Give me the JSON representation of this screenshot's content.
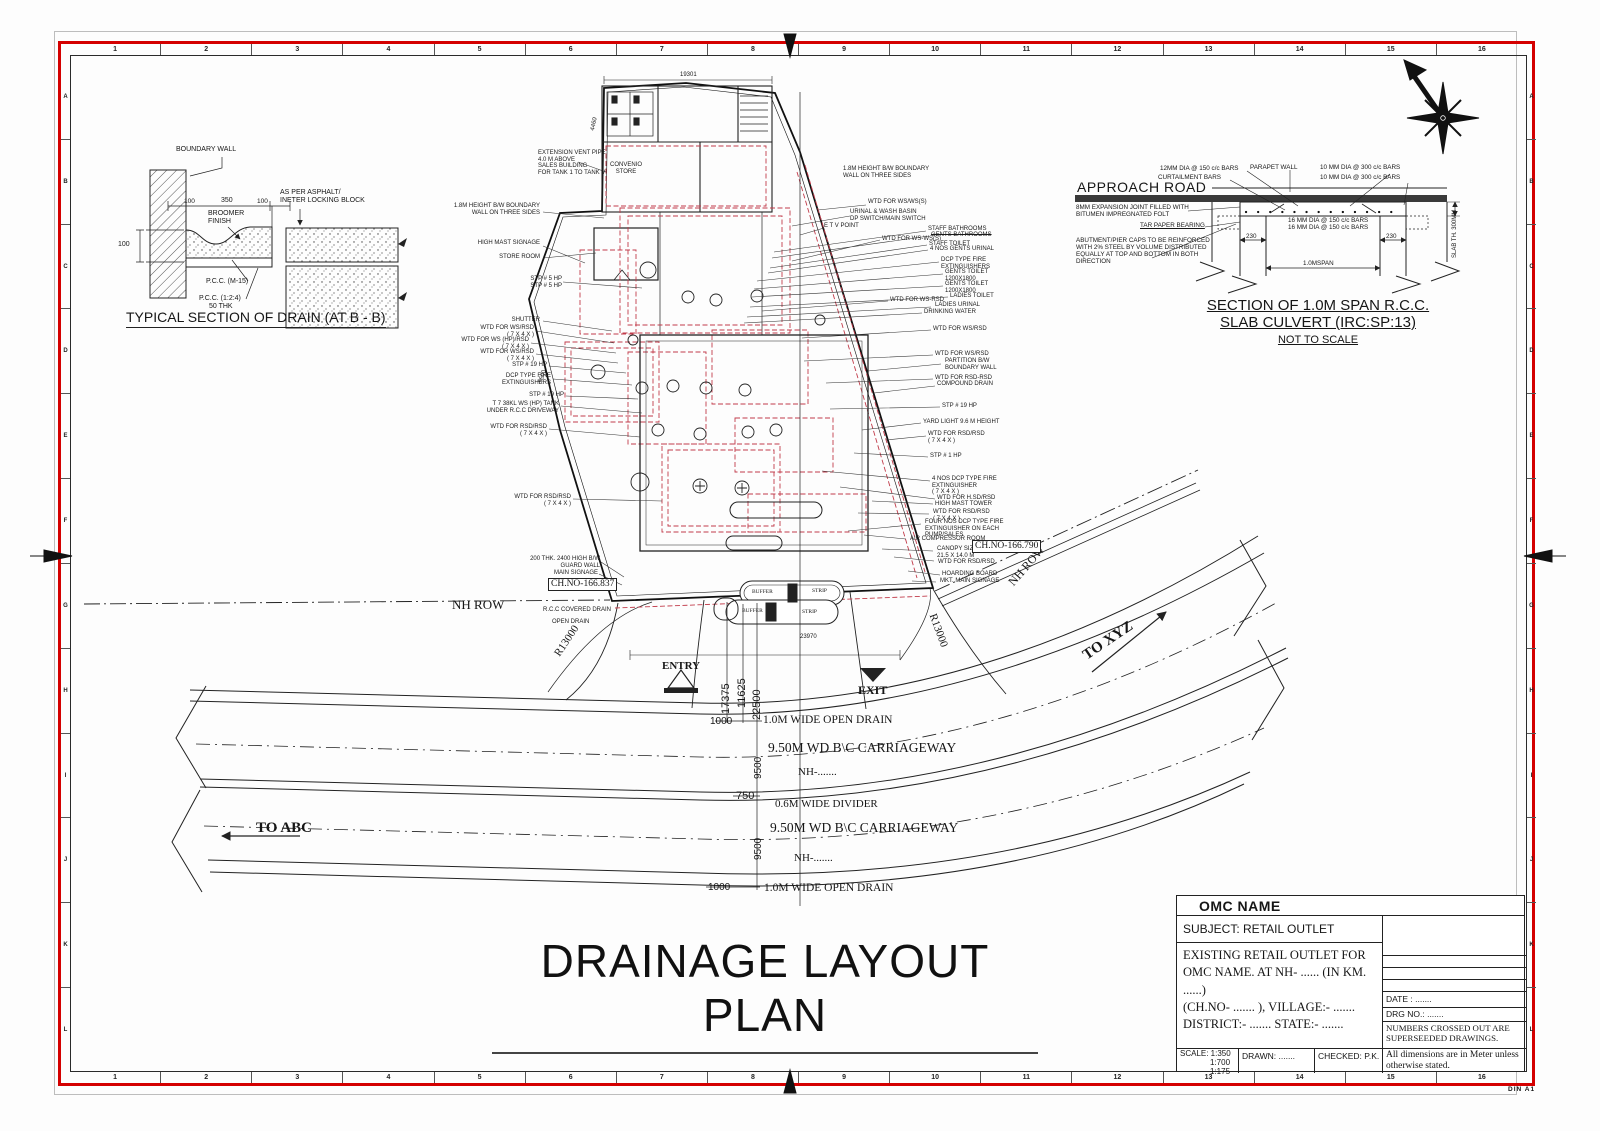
{
  "sheet": {
    "size_label": "DIN  A1"
  },
  "grid": {
    "cols": [
      "1",
      "2",
      "3",
      "4",
      "5",
      "6",
      "7",
      "8",
      "9",
      "10",
      "11",
      "12",
      "13",
      "14",
      "15",
      "16"
    ],
    "rows": [
      "A",
      "B",
      "C",
      "D",
      "E",
      "F",
      "G",
      "H",
      "I",
      "J",
      "K",
      "L"
    ]
  },
  "plan": {
    "title": "DRAINAGE LAYOUT PLAN",
    "small_left": [
      {
        "text": "EXTENSION VENT PIPE\n4.0 M ABOVE\nSALES BUILDING\nFOR TANK 1 TO TANK V",
        "x": 538,
        "y": 150
      },
      {
        "text": "1.8M HEIGHT B/W BOUNDARY\nWALL ON THREE SIDES",
        "x": 540,
        "y": 203,
        "cls": "ra"
      },
      {
        "text": "HIGH MAST SIGNAGE",
        "x": 540,
        "y": 240,
        "cls": "ra"
      },
      {
        "text": "STORE ROOM",
        "x": 540,
        "y": 254,
        "cls": "ra"
      },
      {
        "text": "STP # 5 HP",
        "x": 562,
        "y": 276,
        "cls": "ra"
      },
      {
        "text": "STP # 5 HP",
        "x": 562,
        "y": 283,
        "cls": "ra"
      },
      {
        "text": "SHUTTER",
        "x": 540,
        "y": 317,
        "cls": "ra"
      },
      {
        "text": "WTD FOR WS/RSD\n( 7 X 4 X )",
        "x": 534,
        "y": 325,
        "cls": "ra"
      },
      {
        "text": "WTD FOR WS (HP)/RSD\n( 7 X 4 X )",
        "x": 529,
        "y": 337,
        "cls": "ra"
      },
      {
        "text": "WTD FOR WS/RSD\n( 7 X 4 X )",
        "x": 534,
        "y": 349,
        "cls": "ra"
      },
      {
        "text": "STP # 19 HP",
        "x": 547,
        "y": 362,
        "cls": "ra"
      },
      {
        "text": "DCP TYPE FIRE\nEXTINGUISHERS",
        "x": 551,
        "y": 373,
        "cls": "ra"
      },
      {
        "text": "STP # 19 HP",
        "x": 564,
        "y": 392,
        "cls": "ra"
      },
      {
        "text": "T 7 38KL WS (HP) TANK\nUNDER R.C.C DRIVEWAY",
        "x": 559,
        "y": 401,
        "cls": "ra"
      },
      {
        "text": "WTD FOR RSD/RSD\n( 7 X 4 X )",
        "x": 547,
        "y": 424,
        "cls": "ra"
      },
      {
        "text": "WTD FOR RSD/RSD\n( 7 X 4 X )",
        "x": 571,
        "y": 494,
        "cls": "ra"
      },
      {
        "text": "200 THK. 2400 HIGH B/W\nGUARD WALL",
        "x": 600,
        "y": 556,
        "cls": "ra"
      },
      {
        "text": "MAIN SIGNAGE",
        "x": 598,
        "y": 570,
        "cls": "ra"
      }
    ],
    "small_right": [
      {
        "text": "1.8M HEIGHT B/W BOUNDARY\nWALL ON THREE SIDES",
        "x": 843,
        "y": 166
      },
      {
        "text": "WTD FOR WS/WS(S)",
        "x": 868,
        "y": 199
      },
      {
        "text": "URINAL & WASH BASIN\nDP SWITCH/MAIN SWITCH",
        "x": 850,
        "y": 209
      },
      {
        "text": "E T V POINT",
        "x": 824,
        "y": 223
      },
      {
        "text": "STAFF BATHROOMS",
        "x": 928,
        "y": 226
      },
      {
        "text": "GENTS BATHROOMS",
        "x": 931,
        "y": 232,
        "cls": "strike"
      },
      {
        "text": "WTD FOR WS-WS(S)",
        "x": 882,
        "y": 236
      },
      {
        "text": "STAFF TOILET",
        "x": 929,
        "y": 241
      },
      {
        "text": "4 NOS GENTS URINAL",
        "x": 930,
        "y": 246
      },
      {
        "text": "DCP TYPE FIRE\nEXTINGUISHERS",
        "x": 941,
        "y": 257
      },
      {
        "text": "GENTS TOILET\n1200X1800",
        "x": 945,
        "y": 269
      },
      {
        "text": "GENTS TOILET\n1200X1800",
        "x": 945,
        "y": 281
      },
      {
        "text": "LADIES TOILET",
        "x": 950,
        "y": 293
      },
      {
        "text": "WTD FOR WS-RSD",
        "x": 890,
        "y": 297
      },
      {
        "text": "LADIES URINAL",
        "x": 935,
        "y": 302
      },
      {
        "text": "DRINKING WATER",
        "x": 924,
        "y": 309
      },
      {
        "text": "WTD FOR WS/RSD",
        "x": 933,
        "y": 326
      },
      {
        "text": "WTD FOR WS/RSD",
        "x": 935,
        "y": 351
      },
      {
        "text": "PARTITION B/W\nBOUNDARY WALL",
        "x": 945,
        "y": 358
      },
      {
        "text": "WTD FOR RSD-RSD",
        "x": 935,
        "y": 375
      },
      {
        "text": "COMPOUND DRAIN",
        "x": 937,
        "y": 381
      },
      {
        "text": "STP # 19 HP",
        "x": 942,
        "y": 403
      },
      {
        "text": "YARD LIGHT 9.6 M HEIGHT",
        "x": 923,
        "y": 419
      },
      {
        "text": "WTD FOR RSD/RSD\n( 7 X 4 X )",
        "x": 928,
        "y": 431
      },
      {
        "text": "STP # 1 HP",
        "x": 930,
        "y": 453
      },
      {
        "text": "4 NOS DCP TYPE FIRE\nEXTINGUISHER\n( 7 X 4 X )",
        "x": 932,
        "y": 476
      },
      {
        "text": "WTD FOR H.SD/RSD",
        "x": 937,
        "y": 495
      },
      {
        "text": "HIGH MAST TOWER",
        "x": 935,
        "y": 501
      },
      {
        "text": "WTD FOR RSD/RSD\n( 7 X 4 X )",
        "x": 933,
        "y": 509
      },
      {
        "text": "FOUR NOS DCP TYPE FIRE\nEXTINGUISHER ON EACH\nPUMP/SALES",
        "x": 925,
        "y": 519
      },
      {
        "text": "AIR COMPRESSOR ROOM",
        "x": 910,
        "y": 536
      },
      {
        "text": "CANOPY SIZE\n21.5 X 14.0 M",
        "x": 937,
        "y": 546
      },
      {
        "text": "WTD FOR RSD/RSD",
        "x": 938,
        "y": 559
      },
      {
        "text": "HOARDING BOARD",
        "x": 942,
        "y": 571
      },
      {
        "text": "MKT. MAIN SIGNAGE",
        "x": 940,
        "y": 578
      },
      {
        "text": "CONVENIO\nSTORE",
        "x": 626,
        "y": 162,
        "cls": "ctr"
      },
      {
        "text": "R.C.C COVERED DRAIN",
        "x": 543,
        "y": 607
      },
      {
        "text": "OPEN DRAIN",
        "x": 552,
        "y": 619
      }
    ],
    "road_labels": [
      {
        "text": "NH ROW",
        "x": 452,
        "y": 598,
        "fs": 13
      },
      {
        "text": "NH ROW",
        "x": 1006,
        "y": 580,
        "fs": 12,
        "rot": -49
      },
      {
        "text": "TO ABC",
        "x": 256,
        "y": 820,
        "fs": 15,
        "cls": "b"
      },
      {
        "text": "TO XYZ",
        "x": 1080,
        "y": 650,
        "fs": 15,
        "rot": -34,
        "cls": "b"
      },
      {
        "text": "1.0M WIDE OPEN DRAIN",
        "x": 763,
        "y": 714,
        "fs": 11.5
      },
      {
        "text": "9.50M WD  B\\C CARRIAGEWAY",
        "x": 768,
        "y": 740,
        "fs": 13.5
      },
      {
        "text": "NH-.......",
        "x": 798,
        "y": 766,
        "fs": 11
      },
      {
        "text": "0.6M WIDE DIVIDER",
        "x": 775,
        "y": 798,
        "fs": 11
      },
      {
        "text": "9.50M WD  B\\C CARRIAGEWAY",
        "x": 770,
        "y": 820,
        "fs": 13.5
      },
      {
        "text": "NH-.......",
        "x": 794,
        "y": 852,
        "fs": 11
      },
      {
        "text": "1.0M WIDE OPEN DRAIN",
        "x": 764,
        "y": 882,
        "fs": 11.5
      },
      {
        "text": "R13000",
        "x": 552,
        "y": 652,
        "fs": 11,
        "rot": -56
      },
      {
        "text": "R13000",
        "x": 938,
        "y": 612,
        "fs": 11,
        "rot": 70
      },
      {
        "text": "ENTRY",
        "x": 662,
        "y": 660,
        "fs": 11,
        "cls": "sans b"
      },
      {
        "text": "EXIT",
        "x": 858,
        "y": 684,
        "fs": 12,
        "cls": "sans b"
      },
      {
        "text": "BUFFER",
        "x": 752,
        "y": 589,
        "fs": 5.5,
        "cls": "sans"
      },
      {
        "text": "STRIP",
        "x": 812,
        "y": 588,
        "fs": 5.5,
        "cls": "sans"
      },
      {
        "text": "BUFFER",
        "x": 742,
        "y": 608,
        "fs": 5.5,
        "cls": "sans"
      },
      {
        "text": "STRIP",
        "x": 802,
        "y": 609,
        "fs": 5.5,
        "cls": "sans"
      }
    ],
    "dims": [
      {
        "text": "17375",
        "x": 720,
        "y": 714,
        "fs": 11,
        "rot": -90
      },
      {
        "text": "11625",
        "x": 736,
        "y": 708,
        "fs": 11,
        "rot": -90
      },
      {
        "text": "22500",
        "x": 751,
        "y": 720,
        "fs": 11,
        "rot": -90
      },
      {
        "text": "1000",
        "x": 710,
        "y": 716,
        "fs": 10
      },
      {
        "text": "1000",
        "x": 708,
        "y": 882,
        "fs": 10
      },
      {
        "text": "750",
        "x": 736,
        "y": 790,
        "fs": 11
      },
      {
        "text": "9500",
        "x": 753,
        "y": 779,
        "fs": 10,
        "rot": -90
      },
      {
        "text": "9500",
        "x": 753,
        "y": 860,
        "fs": 10,
        "rot": -90
      },
      {
        "text": "23970",
        "x": 800,
        "y": 634,
        "fs": 6
      },
      {
        "text": "19301",
        "x": 680,
        "y": 72,
        "fs": 6
      },
      {
        "text": "4460",
        "x": 590,
        "y": 130,
        "fs": 6,
        "rot": -78
      },
      {
        "text": "5500",
        "x": 538,
        "y": 382,
        "fs": 6,
        "rot": -72
      }
    ],
    "boxed": [
      {
        "text": "CH.NO-166.837",
        "x": 548,
        "y": 578,
        "fs": 9.5
      },
      {
        "text": "CH.NO-166.790",
        "x": 972,
        "y": 540,
        "fs": 9.5
      }
    ]
  },
  "drain_detail": {
    "title": "TYPICAL SECTION OF DRAIN (AT B - B)",
    "labels": [
      {
        "text": "BOUNDARY WALL",
        "x": 176,
        "y": 146,
        "fs": 7
      },
      {
        "text": "100",
        "x": 184,
        "y": 198,
        "fs": 6.5
      },
      {
        "text": "350",
        "x": 221,
        "y": 197,
        "fs": 7
      },
      {
        "text": "100",
        "x": 257,
        "y": 198,
        "fs": 6.5
      },
      {
        "text": "BROOMER\nFINISH",
        "x": 208,
        "y": 210,
        "fs": 7
      },
      {
        "text": "AS PER ASPHALT/\nINETER LOCKING BLOCK",
        "x": 280,
        "y": 189,
        "fs": 7
      },
      {
        "text": "100",
        "x": 118,
        "y": 241,
        "fs": 7
      },
      {
        "text": "P.C.C. (M-15)",
        "x": 206,
        "y": 278,
        "fs": 7
      },
      {
        "text": "P.C.C. (1:2:4)",
        "x": 199,
        "y": 295,
        "fs": 7
      },
      {
        "text": "50 THK",
        "x": 209,
        "y": 303,
        "fs": 7
      }
    ]
  },
  "culvert": {
    "approach_road": "APPROACH ROAD",
    "title1": "SECTION OF 1.0M SPAN R.C.C.",
    "title2": "SLAB CULVERT (IRC:SP:13)",
    "note": "NOT TO SCALE",
    "labels": [
      {
        "text": "12MM DIA @ 150 c/c BARS",
        "x": 1160,
        "y": 165
      },
      {
        "text": "CURTAILMENT BARS",
        "x": 1158,
        "y": 174
      },
      {
        "text": "PARAPET WALL",
        "x": 1250,
        "y": 164
      },
      {
        "text": "10 MM DIA @ 300 c/c BARS",
        "x": 1320,
        "y": 164
      },
      {
        "text": "10 MM DIA @ 300 c/c BARS",
        "x": 1320,
        "y": 174
      },
      {
        "text": "8MM EXPANSION JOINT FILLED WITH\nBITUMEN IMPREGNATED FOLT",
        "x": 1076,
        "y": 204
      },
      {
        "text": "TAR PAPER BEARING",
        "x": 1140,
        "y": 222,
        "cls": "ul"
      },
      {
        "text": "16 MM DIA @ 150 c/c BARS",
        "x": 1288,
        "y": 217
      },
      {
        "text": "16 MM DIA @ 150 c/c BARS",
        "x": 1288,
        "y": 224
      },
      {
        "text": "230",
        "x": 1246,
        "y": 233
      },
      {
        "text": "230",
        "x": 1386,
        "y": 233
      },
      {
        "text": "ABUTMENT/PIER CAPS TO BE REINFORCED\nWITH 2% STEEL BY VOLUME DISTRIBUTED\nEQUALLY AT TOP AND BOTTOM IN BOTH\nDIRECTION",
        "x": 1076,
        "y": 237
      },
      {
        "text": "1.0MSPAN",
        "x": 1303,
        "y": 260
      },
      {
        "text": "SLAB TH. 300MM",
        "x": 1452,
        "y": 258,
        "fs": 6,
        "rot": -90
      }
    ]
  },
  "title_block": {
    "company": "OMC NAME",
    "subject": "SUBJECT:  RETAIL OUTLET",
    "desc": "EXISTING RETAIL  OUTLET FOR\nOMC NAME. AT NH- ......   (IN KM. ......)\n(CH.NO- ....... ), VILLAGE:- .......\nDISTRICT:- .......   STATE:- .......",
    "date": "DATE : .......",
    "drg_no": "DRG NO.: .......",
    "superseded_note": "NUMBERS CROSSED OUT ARE\nSUPERSEEDED DRAWINGS.",
    "scale_label": "SCALE: 1:350",
    "scale_2": "1:700",
    "scale_3": "1:175",
    "drawn": "DRAWN: .......",
    "checked": "CHECKED: P.K.",
    "dims_note": "All dimensions are in Meter unless\notherwise stated."
  }
}
